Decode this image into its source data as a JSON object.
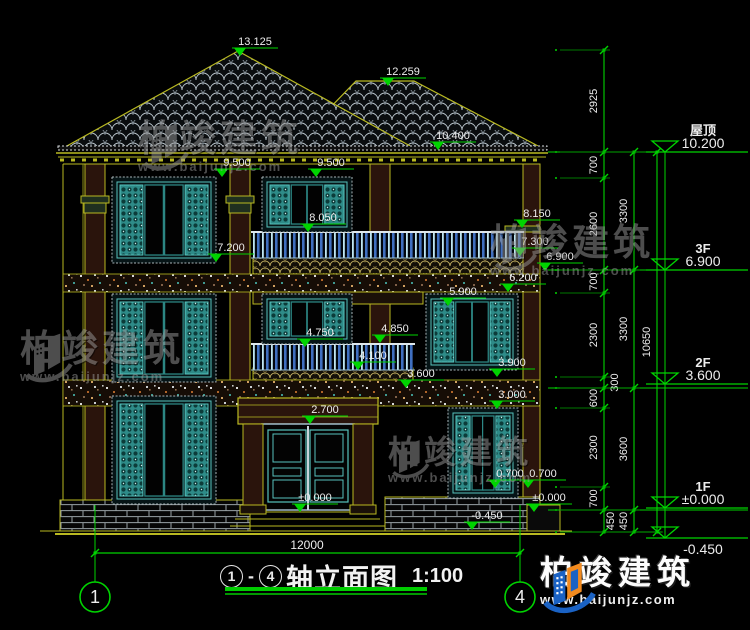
{
  "drawing": {
    "title": {
      "axis_start": "1",
      "axis_end": "4",
      "dash": "-",
      "name": "轴立面图",
      "scale": "1:100"
    },
    "bottom_dimension": "12000",
    "axes": [
      {
        "id": "1",
        "x": 95
      },
      {
        "id": "4",
        "x": 520
      }
    ],
    "floor_levels": [
      {
        "name": "屋顶",
        "value": "10.200",
        "y": 152
      },
      {
        "name": "3F",
        "value": "6.900",
        "y": 270
      },
      {
        "name": "2F",
        "value": "3.600",
        "y": 384
      },
      {
        "name": "1F",
        "value": "±0.000",
        "y": 508
      },
      {
        "name": "",
        "value": "-0.450",
        "y": 538,
        "below": true
      }
    ],
    "dim_chains": [
      {
        "x": 604,
        "ticks": [
          50,
          152,
          178,
          270,
          293,
          377,
          388,
          408,
          487,
          510,
          532
        ],
        "segments": [
          {
            "label": "2925"
          },
          {
            "label": "700"
          },
          {
            "label": "2600"
          },
          {
            "label": "700"
          },
          {
            "label": "2300"
          },
          {
            "label": "300",
            "dx": 14
          },
          {
            "label": "600"
          },
          {
            "label": "2300"
          },
          {
            "label": "700"
          },
          {
            "label": "450",
            "dx": 10
          }
        ]
      },
      {
        "x": 634,
        "ticks": [
          152,
          270,
          388,
          510,
          532
        ],
        "segments": [
          {
            "label": "3300"
          },
          {
            "label": "3300"
          },
          {
            "label": "3600"
          },
          {
            "label": "450"
          }
        ]
      },
      {
        "x": 657,
        "ticks": [
          152,
          532
        ],
        "segments": [
          {
            "label": "10650"
          }
        ]
      }
    ],
    "elevation_markers": [
      {
        "label": "13.125",
        "x": 240,
        "y": 56
      },
      {
        "label": "12.259",
        "x": 388,
        "y": 86
      },
      {
        "label": "10.400",
        "x": 438,
        "y": 150
      },
      {
        "label": "9.500",
        "x": 222,
        "y": 177
      },
      {
        "label": "9.500",
        "x": 316,
        "y": 177
      },
      {
        "label": "8.050",
        "x": 308,
        "y": 232
      },
      {
        "label": "8.150",
        "x": 522,
        "y": 228
      },
      {
        "label": "7.300",
        "x": 520,
        "y": 256
      },
      {
        "label": "7.200",
        "x": 216,
        "y": 262
      },
      {
        "label": "6.900",
        "x": 545,
        "y": 271
      },
      {
        "label": "6.200",
        "x": 508,
        "y": 292
      },
      {
        "label": "5.900",
        "x": 448,
        "y": 306
      },
      {
        "label": "4.750",
        "x": 305,
        "y": 347
      },
      {
        "label": "4.850",
        "x": 380,
        "y": 343
      },
      {
        "label": "4.100",
        "x": 358,
        "y": 370
      },
      {
        "label": "3.900",
        "x": 497,
        "y": 377
      },
      {
        "label": "3.600",
        "x": 406,
        "y": 388
      },
      {
        "label": "3.000",
        "x": 497,
        "y": 409
      },
      {
        "label": "2.700",
        "x": 310,
        "y": 424
      },
      {
        "label": "0.700",
        "x": 495,
        "y": 488
      },
      {
        "label": "0.700",
        "x": 528,
        "y": 488
      },
      {
        "label": "±0.000",
        "x": 300,
        "y": 512
      },
      {
        "label": "±0.000",
        "x": 534,
        "y": 512
      },
      {
        "label": "-0.450",
        "x": 472,
        "y": 530
      }
    ],
    "watermark": {
      "brand": "柏竣建筑",
      "url": "www.baijunjz.com"
    },
    "logo": {
      "brand": "柏竣建筑",
      "url": "www.baijunjz.com"
    },
    "colors": {
      "annotation": "#00d400",
      "building_line": "#b9b921",
      "text": "#ededed",
      "teal": "#2e8b88",
      "watermark": "#9a9a9a"
    }
  }
}
